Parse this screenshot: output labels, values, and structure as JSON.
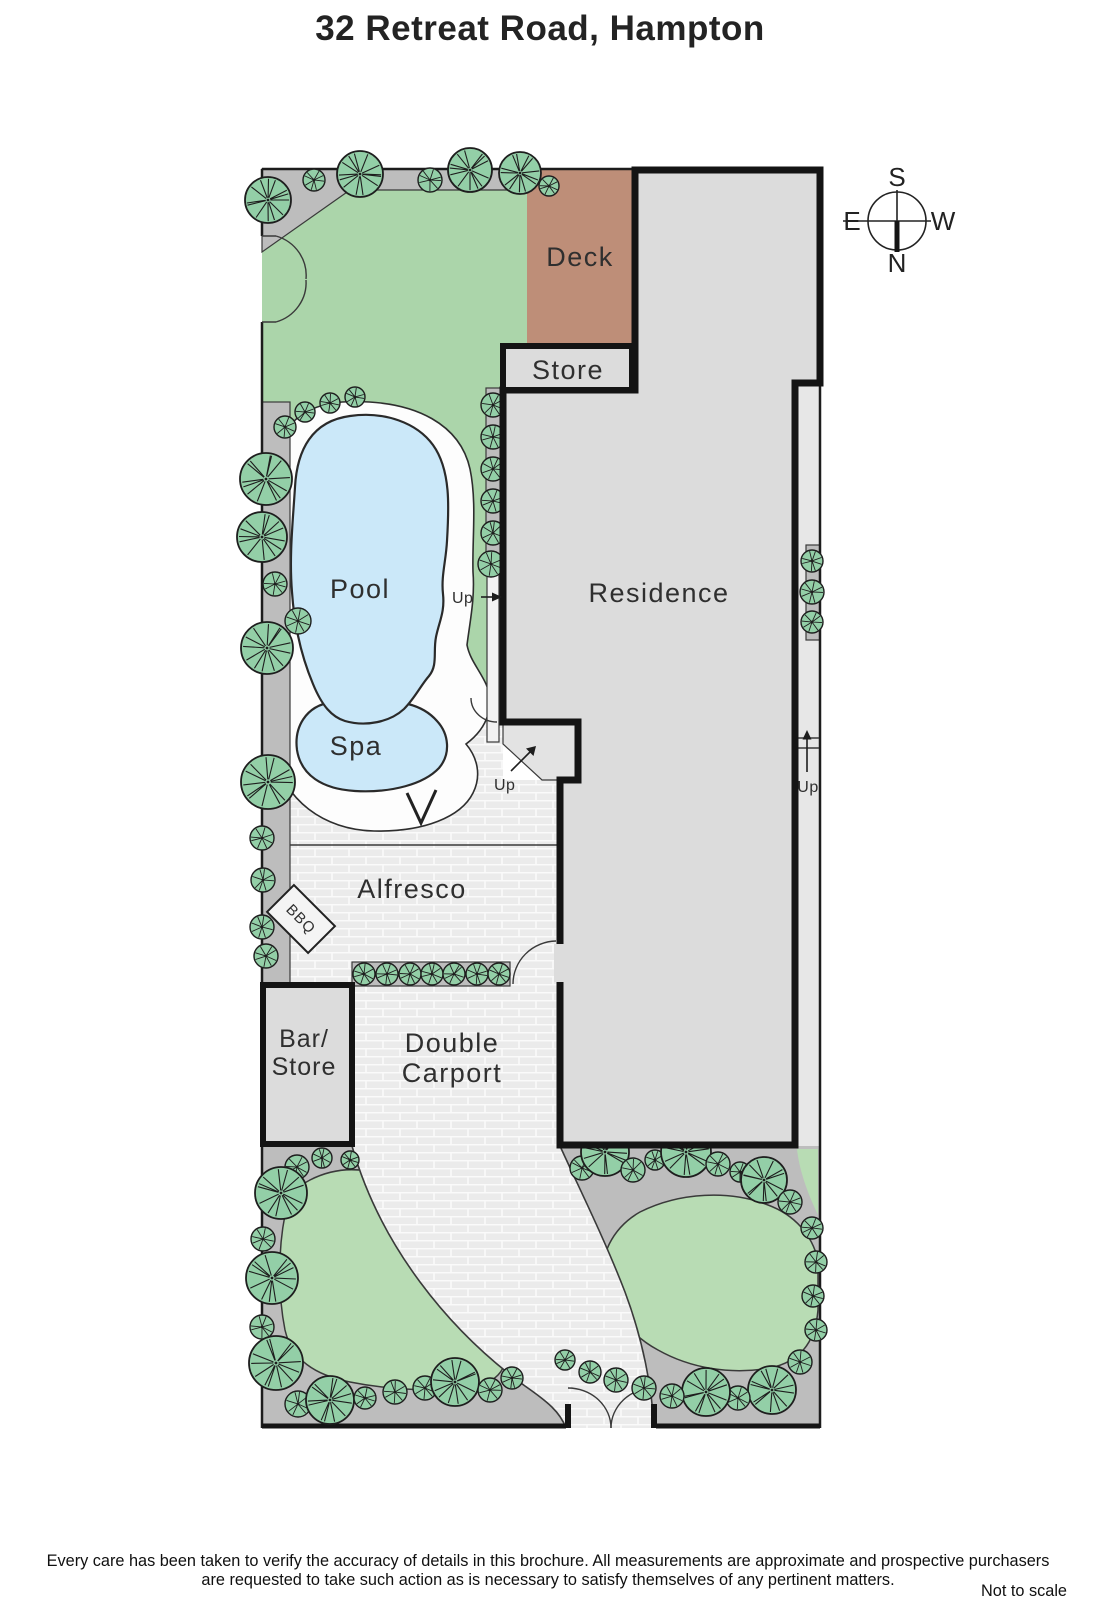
{
  "title": "32 Retreat Road, Hampton",
  "compass": {
    "s": "S",
    "n": "N",
    "e": "E",
    "w": "W"
  },
  "labels": {
    "deck": "Deck",
    "store": "Store",
    "pool": "Pool",
    "spa": "Spa",
    "residence": "Residence",
    "up_pool": "Up",
    "up_landing": "Up",
    "up_side": "Up",
    "alfresco": "Alfresco",
    "bbq": "BBQ",
    "bar_store_line1": "Bar/",
    "bar_store_line2": "Store",
    "carport_line1": "Double",
    "carport_line2": "Carport"
  },
  "footer": {
    "line1": "Every care has been taken to verify the accuracy of details in this brochure.  All measurements are approximate and prospective purchasers",
    "line2": "are requested to take such action as is necessary to satisfy themselves of any pertinent matters.",
    "note": "Not to scale"
  },
  "colors": {
    "wall": "#141414",
    "line": "#3a3a3a",
    "lawn": "#abd5aa",
    "garden_bed": "#b8dcb4",
    "tree": "#93cfa7",
    "tree_line": "#1e1e1e",
    "path_gray": "#bdbdbd",
    "paving": "#ebebeb",
    "deck": "#be8e78",
    "residence": "#dcdcdc",
    "side_strip": "#e7e7e7",
    "pool": "#cbe8f9",
    "landing": "#e3e3e3",
    "text": "#2f2f2f"
  }
}
